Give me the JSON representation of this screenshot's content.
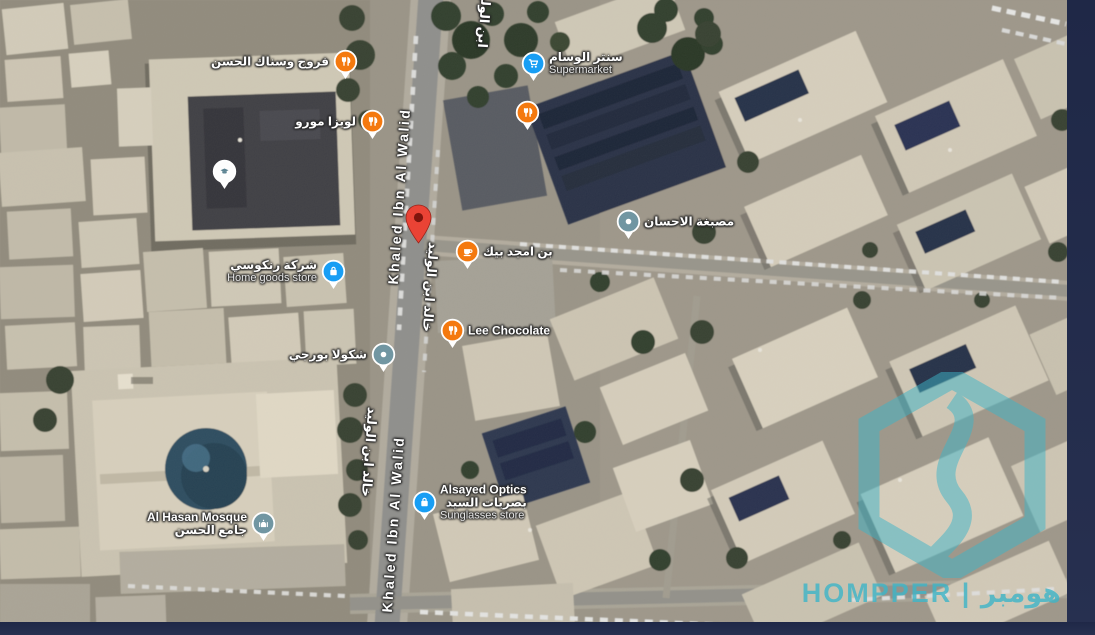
{
  "map": {
    "pin_colors": {
      "orange": "#F4790F",
      "blue": "#189EF4",
      "slate": "#7196A2",
      "white": "#FDFDFD",
      "red": "#EA4335"
    },
    "street_labels": [
      {
        "label": "Khaled Ibn Al Walid",
        "lang": "en",
        "x": 399,
        "y": 196,
        "rotation": -86
      },
      {
        "label": "خالد ابن الوليد",
        "lang": "ar",
        "x": 430,
        "y": 287,
        "rotation": 94
      },
      {
        "label": "خالد ابن الوليد",
        "lang": "ar",
        "x": 369,
        "y": 452,
        "rotation": 94
      },
      {
        "label": "Khaled Ibn Al Walid",
        "lang": "en",
        "x": 393,
        "y": 524,
        "rotation": -86
      },
      {
        "label": "ابن الوليد",
        "lang": "ar",
        "x": 484,
        "y": 18,
        "rotation": 94
      }
    ],
    "pois": [
      {
        "id": "farrouj-snack-alhasan",
        "icon": "restaurant-icon",
        "color": "orange",
        "x": 345,
        "y": 62,
        "side": "left",
        "lines": [
          {
            "text": "فروج وسناك الحسن",
            "style": "ar"
          }
        ]
      },
      {
        "id": "center-alwissam",
        "icon": "cart-icon",
        "color": "blue",
        "x": 533,
        "y": 64,
        "side": "right",
        "lines": [
          {
            "text": "سنتر الوسام",
            "style": "ar"
          },
          {
            "text": "Supermarket",
            "style": "cat"
          }
        ]
      },
      {
        "id": "restaurant-unlabeled",
        "icon": "restaurant-icon",
        "color": "orange",
        "x": 527,
        "y": 113,
        "side": "right",
        "lines": []
      },
      {
        "id": "louiza-moro",
        "icon": "restaurant-icon",
        "color": "orange",
        "x": 372,
        "y": 122,
        "side": "left",
        "lines": [
          {
            "text": "لويزا مورو",
            "style": "ar"
          }
        ]
      },
      {
        "id": "school-unlabeled",
        "icon": "school-icon",
        "color": "white",
        "x": 224,
        "y": 172,
        "side": "right",
        "lines": []
      },
      {
        "id": "masbagha-alihsan",
        "icon": "dot-icon",
        "color": "slate",
        "x": 628,
        "y": 222,
        "side": "right",
        "lines": [
          {
            "text": "مصبغة الاحسان",
            "style": "ar"
          }
        ]
      },
      {
        "id": "bon-amjad-bek",
        "icon": "cafe-icon",
        "color": "orange",
        "x": 467,
        "y": 252,
        "side": "right",
        "lines": [
          {
            "text": "بن امجد بيك",
            "style": "ar"
          }
        ]
      },
      {
        "id": "rankousi-home-goods",
        "icon": "bag-icon",
        "color": "blue",
        "x": 333,
        "y": 272,
        "side": "left",
        "lines": [
          {
            "text": "شركة رنكوسي",
            "style": "ar"
          },
          {
            "text": "Home goods store",
            "style": "cat"
          }
        ]
      },
      {
        "id": "lee-chocolate",
        "icon": "restaurant-icon",
        "color": "orange",
        "x": 452,
        "y": 331,
        "side": "right",
        "lines": [
          {
            "text": "Lee Chocolate",
            "style": "en"
          }
        ]
      },
      {
        "id": "chocola-borji",
        "icon": "dot-icon",
        "color": "slate",
        "x": 383,
        "y": 355,
        "side": "left",
        "lines": [
          {
            "text": "شكولا بورجي",
            "style": "ar"
          }
        ]
      },
      {
        "id": "alsayed-optics",
        "icon": "bag-icon",
        "color": "blue",
        "x": 424,
        "y": 503,
        "side": "right",
        "lines": [
          {
            "text": "Alsayed Optics",
            "style": "en"
          },
          {
            "text": "بصريات السيد",
            "style": "ar"
          },
          {
            "text": "Sunglasses store",
            "style": "cat"
          }
        ]
      },
      {
        "id": "al-hasan-mosque",
        "icon": "mosque-icon",
        "color": "slate",
        "x": 263,
        "y": 524,
        "side": "left",
        "lines": [
          {
            "text": "Al Hasan Mosque",
            "style": "en"
          },
          {
            "text": "جامع الحسن",
            "style": "ar"
          }
        ]
      }
    ],
    "destination_pin": {
      "x": 418,
      "y": 243,
      "color": "red"
    }
  },
  "watermark": {
    "text": "HOMPPER | هومبر",
    "logo": "hexagon-logo",
    "color": "#3db5c8"
  }
}
